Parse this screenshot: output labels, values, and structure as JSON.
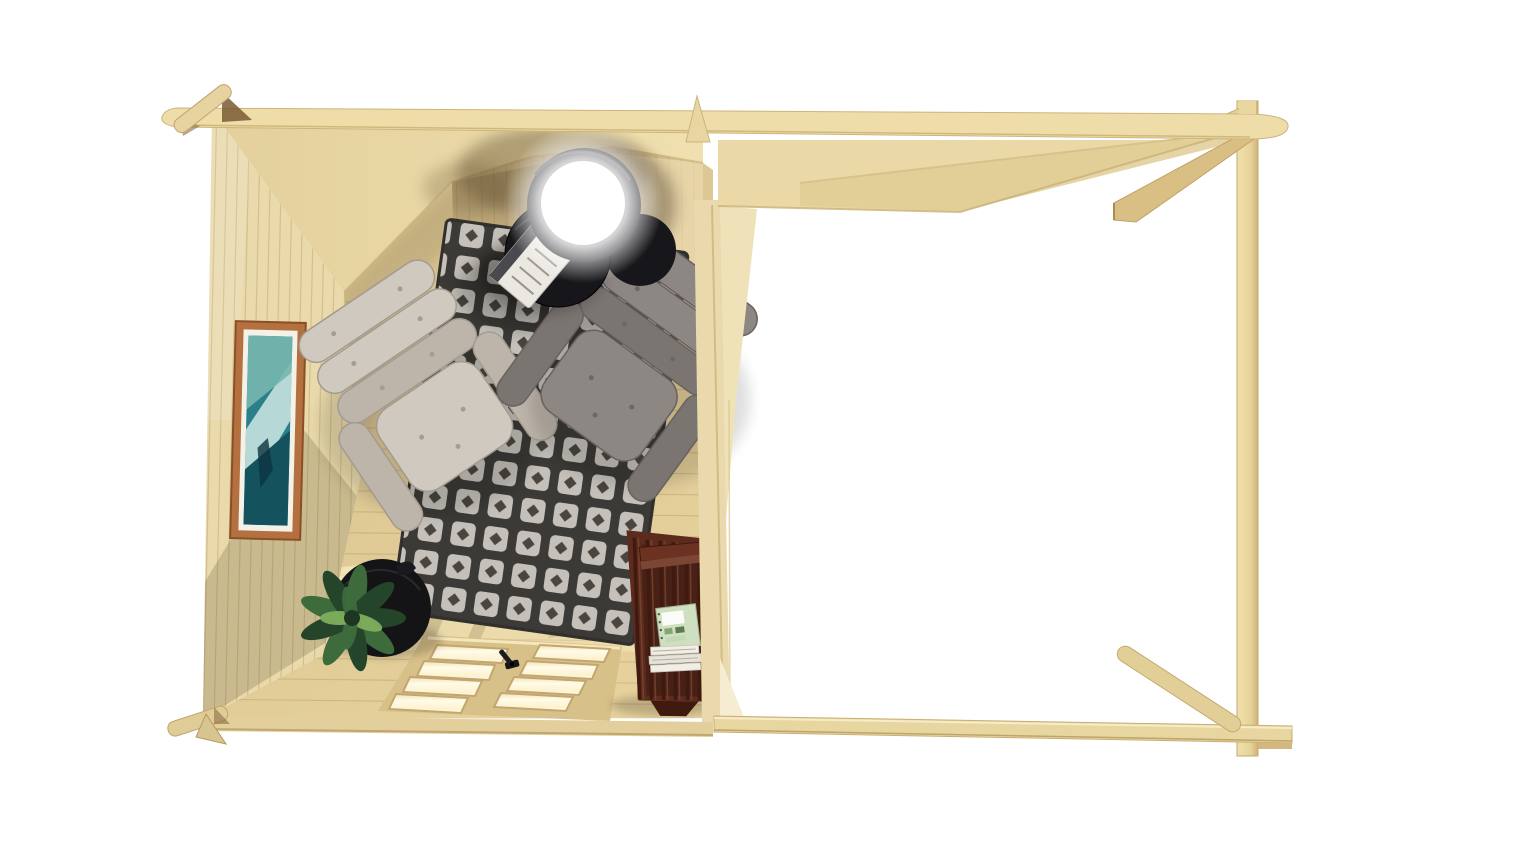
{
  "meta": {
    "canvas": {
      "width": 1536,
      "height": 864
    },
    "background": "#ffffff"
  },
  "palette": {
    "bg": "#ffffff",
    "wood_fascia": "#eedda8",
    "wood_roof": "#ead9a7",
    "wood_roof_dark": "#e0cd95",
    "wood_wall": "#e9d9ab",
    "wood_wall_lit": "#f1e3b8",
    "wood_floor": "#e6d19c",
    "plank_line": "#b89c64",
    "wood_divider": "#ead9ac",
    "wood_post": "#e7d398",
    "wood_beam": "#d9bf83",
    "door_frame": "#d8c089",
    "door_pane": "#fdf2cf",
    "sun_patch": "#fff5d2",
    "rug_dark": "#413f3b",
    "rug_light": "#d6d2ca",
    "rug_dot": "#504d47",
    "chair_light": "#cfc9c0",
    "chair_light_shade": "#bdb5aa",
    "chair_dark": "#8d8783",
    "chair_dark_shade": "#7b7571",
    "table_black": "#17171b",
    "lamp_ring": "#222228",
    "lamp_glow": "#ffffff",
    "pot_black": "#141417",
    "plant_green": "#3d6b3c",
    "plant_green_dark": "#24452a",
    "plant_green_lite": "#7fae5d",
    "shelf_brown": "#5c2b1e",
    "shelf_brown_dark": "#40190f",
    "shelf_brown_lite": "#7a4530",
    "book_white": "#f1eee6",
    "book_green": "#cfe0c0",
    "frame_wood": "#b4713f",
    "mat_white": "#f4f1e8",
    "art_teal": "#2a7f8a",
    "art_deep": "#14525e",
    "shade_warm": "#5f4e2e"
  },
  "scene": {
    "structure": {
      "cabin_label": "log cabin room seen from above",
      "pergola_label": "open pergola extension",
      "roof_label": "roof overhang strip",
      "corner_joint_label": "crossed log corner joint",
      "divider_label": "divider wall between cabin and pergola",
      "post_label": "pergola corner post",
      "beam_label": "pergola base beam",
      "strut_label": "diagonal corner brace",
      "bracket_label": "roof corner bracket",
      "floor_label": "wooden plank floor",
      "left_wall_label": "side wall with picture",
      "back_wall_label": "back wall planks",
      "doors_label": "glazed double doors seen from above",
      "handle_label": "door handle",
      "deck_label": "pergola deck wedge"
    },
    "furniture": {
      "rug_label": "dark patterned area rug",
      "armchair_left_label": "light grey lounge armchair",
      "armchair_right_label": "grey lounge armchair",
      "coffee_table_label": "round black coffee table",
      "side_table_label": "round black side table",
      "lamp_label": "glowing dome table lamp",
      "notebook_label": "notebook on coffee table",
      "plant_label": "leafy potted plant",
      "plant_stand_label": "round black plant stand",
      "bookshelf_label": "mahogany bookshelf",
      "books_label": "stack of white books",
      "magazine_label": "green magazine",
      "picture_label": "framed seascape picture",
      "sun_label": "sunlight patches on floor"
    }
  }
}
